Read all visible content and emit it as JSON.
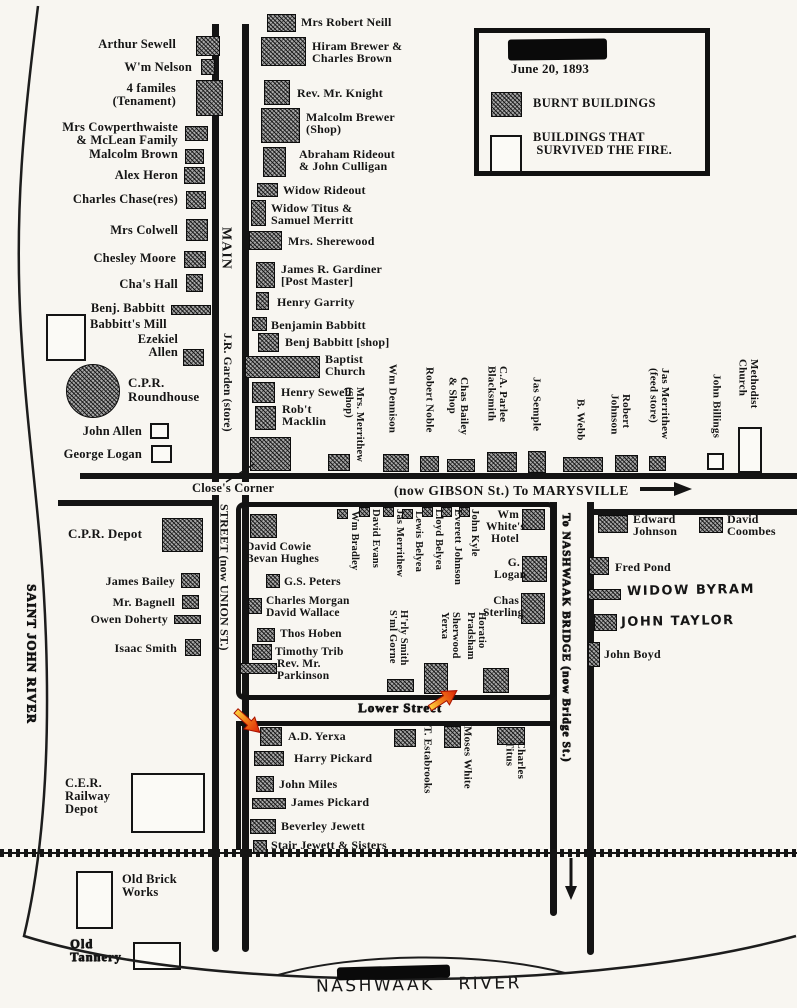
{
  "legend": {
    "date": "June 20, 1893",
    "burnt_label": "BURNT BUILDINGS",
    "survived_label": "BUILDINGS THAT\n SURVIVED THE FIRE."
  },
  "streets": {
    "main": "MAIN",
    "garden": "J.R. Garden (store)",
    "union": "STREET (now UNION ST.)",
    "closes_corner": "Close's Corner",
    "gibson": "(now GIBSON St.) To MARYSVILLE",
    "lower": "Lower Street",
    "bridge": "To NASHWAAK BRIDGE (now Bridge St.)"
  },
  "rivers": {
    "left": "SAINT JOHN RIVER",
    "bottom": "NASHWAAK   RIVER"
  },
  "buildings": [
    {
      "l": "Arthur Sewell",
      "t": "b",
      "r": [
        196,
        36,
        24,
        20
      ],
      "lp": [
        60,
        38
      ],
      "la": "r",
      "lw": 116,
      "fs": 12.5
    },
    {
      "l": "W'm Nelson",
      "t": "b",
      "r": [
        201,
        59,
        14,
        16
      ],
      "lp": [
        62,
        61
      ],
      "la": "r",
      "lw": 130,
      "fs": 12.5
    },
    {
      "l": "4 familes\n(Tenament)",
      "t": "b",
      "r": [
        196,
        80,
        27,
        36
      ],
      "lp": [
        62,
        82
      ],
      "la": "r",
      "lw": 114,
      "fs": 12.5
    },
    {
      "l": "Mrs Cowperthwaiste\n& McLean Family",
      "t": "b",
      "r": [
        185,
        126,
        23,
        15
      ],
      "lp": [
        38,
        121
      ],
      "la": "r",
      "lw": 140,
      "fs": 12.5
    },
    {
      "l": "Malcolm Brown",
      "t": "b",
      "r": [
        185,
        149,
        19,
        15
      ],
      "lp": [
        48,
        148
      ],
      "la": "r",
      "lw": 130,
      "fs": 12.5
    },
    {
      "l": "Alex Heron",
      "t": "b",
      "r": [
        184,
        167,
        21,
        17
      ],
      "lp": [
        48,
        169
      ],
      "la": "r",
      "lw": 130,
      "fs": 12.5
    },
    {
      "l": "Charles Chase(res)",
      "t": "b",
      "r": [
        186,
        191,
        20,
        18
      ],
      "lp": [
        38,
        193
      ],
      "la": "r",
      "lw": 140,
      "fs": 12.5
    },
    {
      "l": "Mrs Colwell",
      "t": "b",
      "r": [
        186,
        219,
        22,
        22
      ],
      "lp": [
        48,
        224
      ],
      "la": "r",
      "lw": 130,
      "fs": 12.5
    },
    {
      "l": "Chesley Moore",
      "t": "b",
      "r": [
        184,
        251,
        22,
        17
      ],
      "lp": [
        48,
        252
      ],
      "la": "r",
      "lw": 128,
      "fs": 12.5
    },
    {
      "l": "Cha's Hall",
      "t": "b",
      "r": [
        186,
        274,
        17,
        18
      ],
      "lp": [
        48,
        278
      ],
      "la": "r",
      "lw": 130,
      "fs": 12.5
    },
    {
      "l": "Benj. Babbitt",
      "t": "b",
      "r": [
        171,
        305,
        40,
        10
      ],
      "lp": [
        38,
        302
      ],
      "la": "r",
      "lw": 127,
      "fs": 12.5
    },
    {
      "l": "Babbitt's Mill",
      "t": "s",
      "r": [
        46,
        314,
        40,
        47
      ],
      "lp": [
        90,
        318
      ],
      "fs": 12.5
    },
    {
      "l": "Ezekiel\nAllen",
      "t": "b",
      "r": [
        183,
        349,
        21,
        17
      ],
      "lp": [
        106,
        333
      ],
      "la": "r",
      "lw": 72,
      "fs": 12.5
    },
    {
      "l": "C.P.R.\nRoundhouse",
      "t": "b",
      "c": 1,
      "r": [
        66,
        364,
        54,
        54
      ],
      "lp": [
        128,
        376
      ],
      "fs": 13
    },
    {
      "l": "John Allen",
      "t": "s",
      "r": [
        150,
        423,
        19,
        16
      ],
      "lp": [
        58,
        425
      ],
      "la": "r",
      "lw": 84,
      "fs": 12.5
    },
    {
      "l": "George Logan",
      "t": "s",
      "r": [
        151,
        445,
        21,
        18
      ],
      "lp": [
        46,
        448
      ],
      "la": "r",
      "lw": 96,
      "fs": 12.5
    },
    {
      "l": "Mrs Robert Neill",
      "t": "b",
      "r": [
        267,
        14,
        29,
        18
      ],
      "lp": [
        301,
        16
      ],
      "fs": 12
    },
    {
      "l": "Hiram Brewer &\nCharles Brown",
      "t": "b",
      "r": [
        261,
        37,
        45,
        29
      ],
      "lp": [
        312,
        40
      ],
      "fs": 12
    },
    {
      "l": "Rev. Mr. Knight",
      "t": "b",
      "r": [
        264,
        80,
        26,
        25
      ],
      "lp": [
        297,
        87
      ],
      "fs": 12
    },
    {
      "l": "Malcolm Brewer\n(Shop)",
      "t": "b",
      "r": [
        261,
        108,
        39,
        35
      ],
      "lp": [
        306,
        111
      ],
      "fs": 12
    },
    {
      "l": "Abraham Rideout\n& John Culligan",
      "t": "b",
      "r": [
        263,
        147,
        23,
        30
      ],
      "lp": [
        299,
        148
      ],
      "fs": 12
    },
    {
      "l": "Widow Rideout",
      "t": "b",
      "r": [
        257,
        183,
        21,
        14
      ],
      "lp": [
        283,
        184
      ],
      "fs": 12
    },
    {
      "l": "Widow Titus &\nSamuel Merritt",
      "t": "b",
      "r": [
        251,
        200,
        15,
        26
      ],
      "lp": [
        271,
        202
      ],
      "fs": 12
    },
    {
      "l": "Mrs. Sherewood",
      "t": "b",
      "r": [
        249,
        231,
        33,
        19
      ],
      "lp": [
        288,
        235
      ],
      "fs": 12
    },
    {
      "l": "James R. Gardiner\n[Post Master]",
      "t": "b",
      "r": [
        256,
        262,
        19,
        26
      ],
      "lp": [
        281,
        263
      ],
      "fs": 12
    },
    {
      "l": "Henry Garrity",
      "t": "b",
      "r": [
        256,
        292,
        13,
        18
      ],
      "lp": [
        277,
        296
      ],
      "fs": 12
    },
    {
      "l": "Benjamin Babbitt",
      "t": "b",
      "r": [
        252,
        317,
        15,
        14
      ],
      "lp": [
        271,
        319
      ],
      "fs": 12
    },
    {
      "l": "Benj Babbitt [shop]",
      "t": "b",
      "r": [
        258,
        333,
        21,
        19
      ],
      "lp": [
        285,
        336
      ],
      "fs": 12
    },
    {
      "l": "Baptist\nChurch",
      "t": "b",
      "r": [
        245,
        356,
        75,
        22
      ],
      "lp": [
        325,
        353
      ],
      "fs": 12
    },
    {
      "l": "Henry Sewell",
      "t": "b",
      "r": [
        252,
        382,
        23,
        21
      ],
      "lp": [
        281,
        386
      ],
      "fs": 12
    },
    {
      "l": "Rob't\nMacklin",
      "t": "b",
      "r": [
        255,
        406,
        21,
        24
      ],
      "lp": [
        282,
        403
      ],
      "fs": 12
    },
    {
      "t": "b",
      "r": [
        250,
        437,
        41,
        34
      ]
    },
    {
      "l": "Mrs. Merrithew\n(Shop)",
      "t": "b",
      "r": [
        328,
        454,
        22,
        17
      ],
      "lp": [
        342,
        387
      ],
      "v": 1,
      "fs": 10.5
    },
    {
      "l": "Wm Dennison",
      "t": "b",
      "r": [
        383,
        454,
        26,
        18
      ],
      "lp": [
        386,
        364
      ],
      "v": 1,
      "fs": 11
    },
    {
      "l": "Robert Noble",
      "t": "b",
      "r": [
        420,
        456,
        19,
        16
      ],
      "lp": [
        423,
        367
      ],
      "v": 1,
      "fs": 11
    },
    {
      "l": "Chas Bailey\n& Shop",
      "t": "b",
      "r": [
        447,
        459,
        28,
        13
      ],
      "lp": [
        446,
        377
      ],
      "v": 1,
      "fs": 11
    },
    {
      "l": "C.A. Parlee\nBlacksmith",
      "t": "b",
      "r": [
        487,
        452,
        30,
        20
      ],
      "lp": [
        485,
        366
      ],
      "v": 1,
      "fs": 11
    },
    {
      "l": "Jas Semple",
      "t": "b",
      "r": [
        528,
        451,
        18,
        22
      ],
      "lp": [
        530,
        377
      ],
      "v": 1,
      "fs": 11
    },
    {
      "l": "B. Webb",
      "t": "b",
      "r": [
        563,
        457,
        40,
        15
      ],
      "lp": [
        574,
        399
      ],
      "v": 1,
      "fs": 11
    },
    {
      "l": "Robert\nJohnson",
      "t": "b",
      "r": [
        615,
        455,
        23,
        17
      ],
      "lp": [
        608,
        394
      ],
      "v": 1,
      "fs": 11
    },
    {
      "l": "Jas Merrithew\n(feed store)",
      "t": "b",
      "r": [
        649,
        456,
        17,
        15
      ],
      "lp": [
        647,
        368
      ],
      "v": 1,
      "fs": 11
    },
    {
      "l": "John Billings",
      "t": "s",
      "r": [
        707,
        453,
        17,
        17
      ],
      "lp": [
        710,
        374
      ],
      "v": 1,
      "fs": 11
    },
    {
      "l": "Methodist\nChurch",
      "t": "s",
      "r": [
        738,
        427,
        24,
        46
      ],
      "lp": [
        736,
        359
      ],
      "v": 1,
      "fs": 11
    },
    {
      "t": "b",
      "r": [
        250,
        514,
        27,
        24
      ]
    },
    {
      "l": "David Cowie\nBevan Hughes",
      "lp": [
        246,
        542
      ],
      "fs": 11.5
    },
    {
      "l": "G.S. Peters",
      "t": "b",
      "r": [
        266,
        574,
        14,
        14
      ],
      "lp": [
        284,
        577
      ],
      "fs": 11.5
    },
    {
      "l": "Charles Morgan\nDavid Wallace",
      "t": "b",
      "r": [
        248,
        598,
        14,
        16
      ],
      "lp": [
        266,
        596
      ],
      "fs": 11.5
    },
    {
      "l": "Thos Hoben",
      "t": "b",
      "r": [
        257,
        628,
        18,
        14
      ],
      "lp": [
        280,
        629
      ],
      "fs": 11.5
    },
    {
      "l": "Timothy Trib",
      "t": "b",
      "r": [
        252,
        644,
        20,
        16
      ],
      "lp": [
        275,
        647
      ],
      "fs": 11.5
    },
    {
      "l": "Rev. Mr.\nParkinson",
      "t": "b",
      "r": [
        240,
        663,
        37,
        11
      ],
      "lp": [
        277,
        659
      ],
      "fs": 11.5
    },
    {
      "l": "Wm Bradley",
      "t": "b",
      "r": [
        337,
        509,
        11,
        10
      ],
      "lp": [
        348,
        511
      ],
      "v": 1,
      "fs": 10.5
    },
    {
      "l": "David Evans",
      "t": "b",
      "r": [
        359,
        507,
        11,
        10
      ],
      "lp": [
        369,
        509
      ],
      "v": 1,
      "fs": 10.5
    },
    {
      "l": "Jas Merrithew",
      "t": "b",
      "r": [
        383,
        507,
        11,
        10
      ],
      "lp": [
        393,
        509
      ],
      "v": 1,
      "fs": 10.5
    },
    {
      "l": "Lewis Belyea",
      "t": "b",
      "r": [
        402,
        509,
        11,
        10
      ],
      "lp": [
        412,
        511
      ],
      "v": 1,
      "fs": 10.5
    },
    {
      "l": "Lloyd Belyea",
      "t": "b",
      "r": [
        422,
        507,
        11,
        10
      ],
      "lp": [
        432,
        509
      ],
      "v": 1,
      "fs": 10.5
    },
    {
      "l": "Everett Johnson",
      "t": "b",
      "r": [
        441,
        507,
        11,
        10
      ],
      "lp": [
        451,
        509
      ],
      "v": 1,
      "fs": 10.5
    },
    {
      "l": "John Kyle",
      "t": "b",
      "r": [
        459,
        507,
        11,
        10
      ],
      "lp": [
        468,
        509
      ],
      "v": 1,
      "fs": 10.5
    },
    {
      "l": "Wm\nWhite's\nHotel",
      "t": "b",
      "r": [
        522,
        509,
        23,
        21
      ],
      "lp": [
        486,
        510
      ],
      "la": "r",
      "lw": 33,
      "fs": 11.5
    },
    {
      "l": "G.\nLogan",
      "t": "b",
      "r": [
        522,
        556,
        25,
        26
      ],
      "lp": [
        494,
        558
      ],
      "la": "r",
      "lw": 26,
      "fs": 11.5
    },
    {
      "l": "Chas\nSterling",
      "t": "b",
      "r": [
        521,
        593,
        24,
        31
      ],
      "lp": [
        483,
        596
      ],
      "la": "r",
      "lw": 36,
      "fs": 11.5
    },
    {
      "l": "H'rly Smith\nS'ml Gorne",
      "t": "b",
      "r": [
        387,
        679,
        27,
        13
      ],
      "lp": [
        386,
        610
      ],
      "v": 1,
      "fs": 10.5
    },
    {
      "l": "Sherwood\nYerxa",
      "t": "b",
      "r": [
        424,
        663,
        24,
        31
      ],
      "lp": [
        438,
        612
      ],
      "v": 1,
      "fs": 10.5
    },
    {
      "l": "Horatio\nPradsham",
      "lp": [
        464,
        612
      ],
      "v": 1,
      "fs": 10.5
    },
    {
      "t": "b",
      "r": [
        483,
        668,
        26,
        25
      ]
    },
    {
      "l": "Edward\nJohnson",
      "t": "b",
      "r": [
        598,
        515,
        30,
        18
      ],
      "lp": [
        633,
        513
      ],
      "fs": 12
    },
    {
      "l": "David\nCoombes",
      "t": "b",
      "r": [
        699,
        517,
        24,
        16
      ],
      "lp": [
        727,
        513
      ],
      "fs": 12
    },
    {
      "l": "Fred Pond",
      "t": "b",
      "r": [
        589,
        557,
        20,
        18
      ],
      "lp": [
        615,
        561
      ],
      "fs": 12
    },
    {
      "l": "WIDOW BYRAM",
      "t": "b",
      "r": [
        588,
        589,
        33,
        11
      ],
      "lp": [
        627,
        584
      ],
      "hand": 1,
      "fs": 13
    },
    {
      "l": "JOHN TAYLOR",
      "t": "b",
      "r": [
        594,
        614,
        23,
        17
      ],
      "lp": [
        621,
        615
      ],
      "hand": 1,
      "fs": 13
    },
    {
      "l": "John Boyd",
      "t": "b",
      "r": [
        588,
        642,
        12,
        25
      ],
      "lp": [
        604,
        648
      ],
      "fs": 12
    },
    {
      "l": "C.P.R. Depot",
      "t": "b",
      "r": [
        162,
        518,
        41,
        34
      ],
      "lp": [
        68,
        527
      ],
      "fs": 13
    },
    {
      "l": "James Bailey",
      "t": "b",
      "r": [
        181,
        573,
        19,
        15
      ],
      "lp": [
        95,
        575
      ],
      "la": "r",
      "lw": 80,
      "fs": 12
    },
    {
      "l": "Mr. Bagnell",
      "t": "b",
      "r": [
        182,
        595,
        17,
        14
      ],
      "lp": [
        95,
        596
      ],
      "la": "r",
      "lw": 80,
      "fs": 12
    },
    {
      "l": "Owen Doherty",
      "t": "b",
      "r": [
        174,
        615,
        27,
        9
      ],
      "lp": [
        80,
        613
      ],
      "la": "r",
      "lw": 88,
      "fs": 12
    },
    {
      "l": "Isaac Smith",
      "t": "b",
      "r": [
        185,
        639,
        16,
        17
      ],
      "lp": [
        95,
        642
      ],
      "la": "r",
      "lw": 82,
      "fs": 12
    },
    {
      "l": "C.E.R.\nRailway\nDepot",
      "t": "s",
      "r": [
        131,
        773,
        74,
        60
      ],
      "lp": [
        65,
        777
      ],
      "fs": 12.5
    },
    {
      "l": "Old Brick\nWorks",
      "t": "s",
      "r": [
        76,
        871,
        37,
        58
      ],
      "lp": [
        122,
        873
      ],
      "fs": 12.5
    },
    {
      "l": "Old\nTannery",
      "t": "s",
      "r": [
        133,
        942,
        48,
        28
      ],
      "lp": [
        70,
        938
      ],
      "fs": 12.5,
      "smudge": 1
    },
    {
      "l": "A.D. Yerxa",
      "t": "b",
      "r": [
        260,
        727,
        22,
        19
      ],
      "lp": [
        288,
        730
      ],
      "fs": 12
    },
    {
      "l": "Harry Pickard",
      "t": "b",
      "r": [
        254,
        751,
        30,
        15
      ],
      "lp": [
        294,
        752
      ],
      "fs": 12
    },
    {
      "l": "John Miles",
      "t": "b",
      "r": [
        256,
        776,
        18,
        16
      ],
      "lp": [
        279,
        778
      ],
      "fs": 12
    },
    {
      "l": "James Pickard",
      "t": "b",
      "r": [
        252,
        798,
        34,
        11
      ],
      "lp": [
        291,
        796
      ],
      "fs": 12
    },
    {
      "l": "Beverley Jewett",
      "t": "b",
      "r": [
        250,
        819,
        26,
        15
      ],
      "lp": [
        281,
        820
      ],
      "fs": 12
    },
    {
      "l": "Stair Jewett & Sisters",
      "t": "b",
      "r": [
        253,
        840,
        14,
        13
      ],
      "lp": [
        271,
        839
      ],
      "fs": 12
    },
    {
      "l": "T. Estabrooks",
      "t": "b",
      "r": [
        394,
        729,
        22,
        18
      ],
      "lp": [
        421,
        726
      ],
      "v": 1,
      "fs": 11
    },
    {
      "l": "Moses White",
      "t": "b",
      "r": [
        444,
        726,
        17,
        22
      ],
      "lp": [
        461,
        726
      ],
      "v": 1,
      "fs": 11
    },
    {
      "l": "Charles\nTitus",
      "t": "b",
      "r": [
        497,
        727,
        28,
        18
      ],
      "lp": [
        503,
        741
      ],
      "v": 1,
      "fs": 11
    }
  ]
}
